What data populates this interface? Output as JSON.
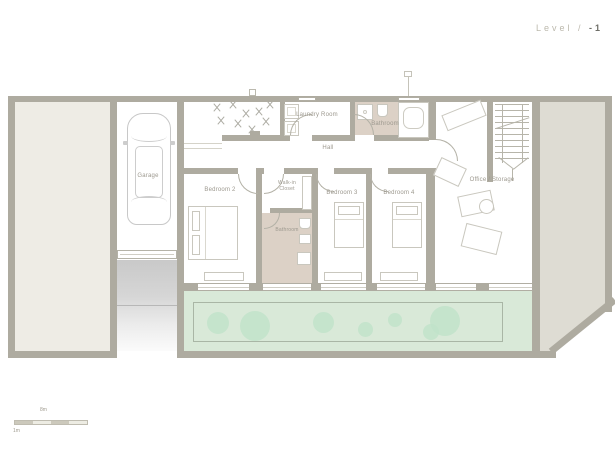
{
  "title": {
    "prefix": "Level /",
    "number": "-1"
  },
  "legend": {
    "scale_top": "8m",
    "scale_bottom": "1m"
  },
  "rooms": {
    "garage": "Garage",
    "laundry": "Laundry Room",
    "hall": "Hall",
    "bathroom_main": "Bathroom",
    "office": "Office / Storage",
    "bedroom2": "Bedroom 2",
    "walkin_closet": "Walk-in Closet",
    "bathroom_small": "Bathroom",
    "bedroom3": "Bedroom 3",
    "bedroom4": "Bedroom 4"
  },
  "colors": {
    "wall": "#aeaba0",
    "yard_left": "#eeece5",
    "yard_right": "#dedcd3",
    "bathroom_floor": "#dcd1c6",
    "garden": "#d9e9d8",
    "bush": "#bfe2c9",
    "label_text": "#9c988e",
    "title_text": "#bcb9ad",
    "title_number": "#6e6e68"
  },
  "garden": {
    "bushes": [
      {
        "x": 207,
        "y": 312,
        "d": 22
      },
      {
        "x": 240,
        "y": 311,
        "d": 30
      },
      {
        "x": 313,
        "y": 312,
        "d": 21
      },
      {
        "x": 358,
        "y": 322,
        "d": 15
      },
      {
        "x": 388,
        "y": 313,
        "d": 14
      },
      {
        "x": 430,
        "y": 306,
        "d": 30
      },
      {
        "x": 423,
        "y": 324,
        "d": 16
      }
    ]
  },
  "courtyard": {
    "plants": [
      {
        "x": 212,
        "y": 102
      },
      {
        "x": 228,
        "y": 99
      },
      {
        "x": 241,
        "y": 108
      },
      {
        "x": 216,
        "y": 115
      },
      {
        "x": 233,
        "y": 118
      },
      {
        "x": 254,
        "y": 106
      },
      {
        "x": 265,
        "y": 99
      },
      {
        "x": 261,
        "y": 116
      },
      {
        "x": 247,
        "y": 124
      }
    ]
  }
}
